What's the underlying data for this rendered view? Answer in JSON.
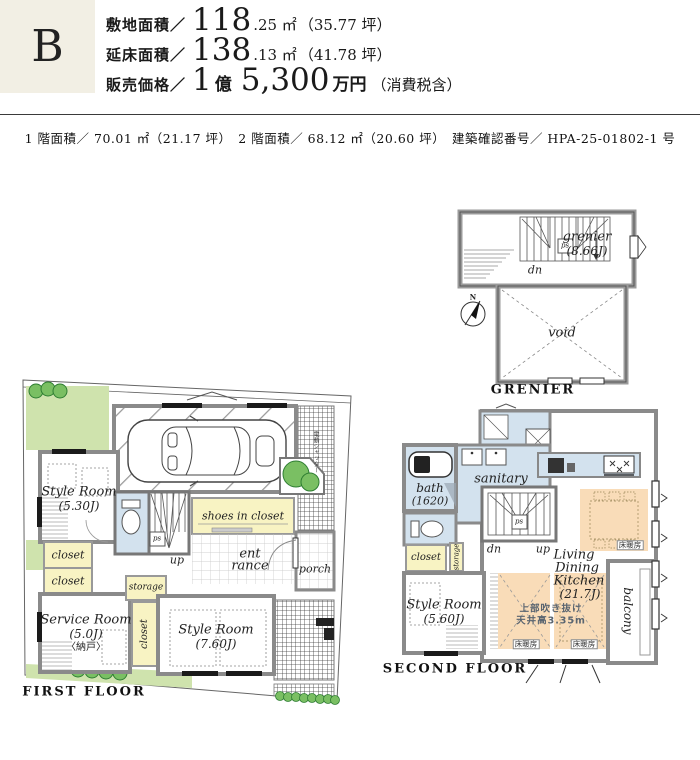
{
  "header": {
    "unit": "B",
    "site": {
      "label": "敷地面積／",
      "big": "118",
      "small": ".25 ㎡",
      "paren": "（35.77 坪）"
    },
    "floor": {
      "label": "延床面積／",
      "big": "138",
      "small": ".13 ㎡",
      "paren": "（41.78 坪）"
    },
    "price": {
      "label": "販売価格／",
      "big1": "1",
      "unit1": "億",
      "big2": "5,300",
      "unit2": "万円",
      "paren": "（消費税含）"
    }
  },
  "subheader": "1 階面積／ 70.01 ㎡（21.17 坪）　2 階面積／ 68.12 ㎡（20.60 坪）　建築確認番号／ HPA-25-01802-1 号",
  "grenier": {
    "title": "GRENIER",
    "room": "grenier",
    "size": "(8.66J)",
    "dn": "dn",
    "ps": "ps",
    "void_label": "void",
    "north": "N"
  },
  "first": {
    "title": "FIRST FLOOR",
    "style1_name": "Style Room",
    "style1_size": "(5.30J)",
    "closet_a": "closet",
    "closet_b": "closet",
    "closet_c": "closet",
    "service_name": "Service Room",
    "service_size": "(5.0J)",
    "service_note": "〈納戸〉",
    "storage": "storage",
    "style2_name": "Style Room",
    "style2_size": "(7.60J)",
    "shoes": "shoes in closet",
    "ent1": "ent",
    "ent2": "rance",
    "porch": "porch",
    "up": "up",
    "ps": "ps",
    "shutter": "電動シャッター"
  },
  "second": {
    "title": "SECOND FLOOR",
    "bath_name": "bath",
    "bath_size": "(1620)",
    "sanitary": "sanitary",
    "closet": "closet",
    "storage": "storage",
    "style_name": "Style Room",
    "style_size": "(5.60J)",
    "ldk1": "Living",
    "ldk2": "Dining",
    "ldk3": "Kitchen",
    "ldk_size": "(21.7J)",
    "void1": "上部吹き抜け",
    "void2": "天井高3.35m",
    "heating": "床暖房",
    "balcony": "balcony",
    "dn": "dn",
    "up": "up",
    "ps": "ps"
  },
  "colors": {
    "accent_beige": "#f2efe4",
    "garden_green": "#cfe3ad",
    "closet_yellow": "#f8f3c3",
    "water_blue": "#d3e2ee",
    "heating_orange": "#f9dcb8",
    "eaves_tan": "#cfc49a"
  }
}
